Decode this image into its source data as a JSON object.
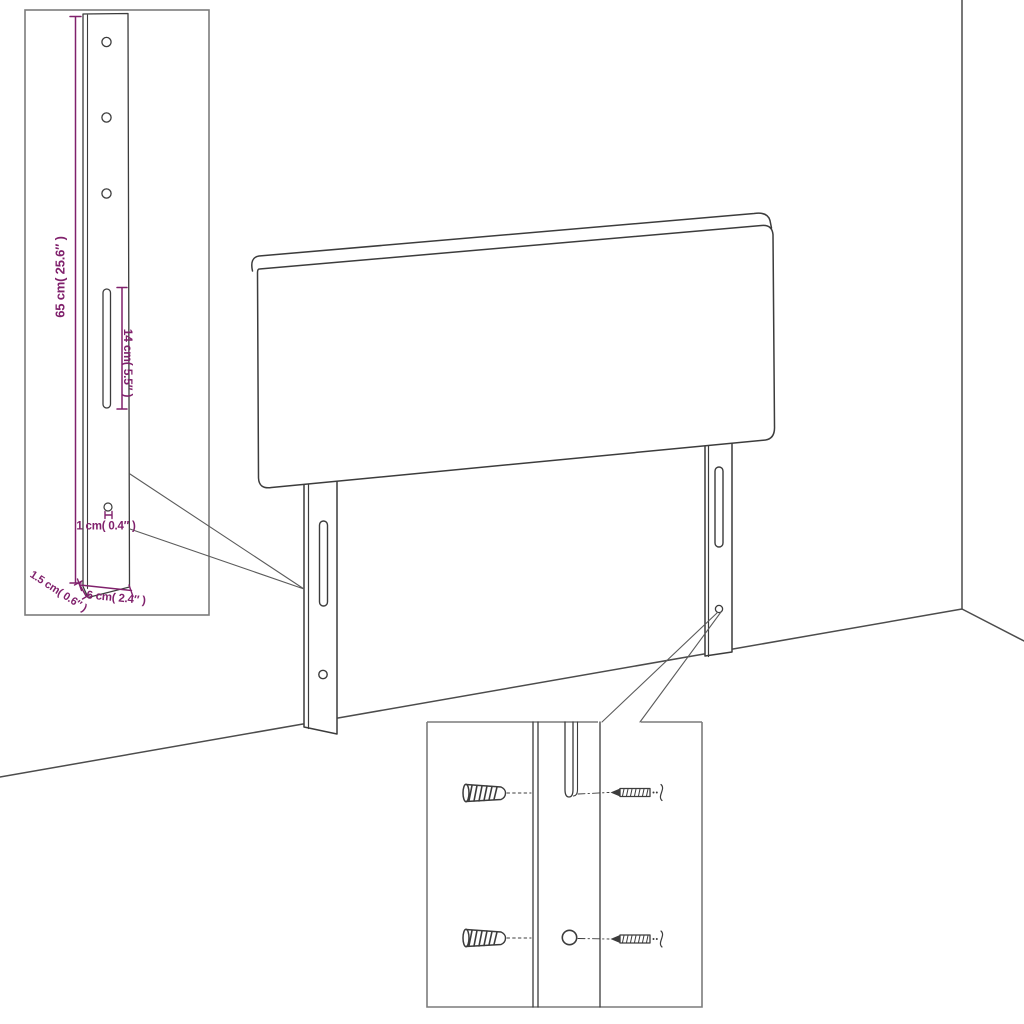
{
  "diagram_title": "headboard-assembly-dimension-diagram",
  "bracket_detail_inset": {
    "height_label": "65 cm( 25.6″ )",
    "slot_label": "14 cm( 5.5″ )",
    "hole_label": "1 cm( 0.4″ )",
    "thickness_label": "1.5 cm( 0.6″ )",
    "width_label": "6 cm( 2.4″ )"
  },
  "hardware_detail_inset": {
    "parts": [
      "wall-plug",
      "wall-plug",
      "screw",
      "screw"
    ]
  },
  "colors": {
    "dimension_text": "#80216c",
    "line_art": "#3c3c3c",
    "wall_line": "#4c4c4c",
    "inset_border": "#7c7c7c",
    "leader_line": "#5b5b5b",
    "background": "#ffffff"
  }
}
